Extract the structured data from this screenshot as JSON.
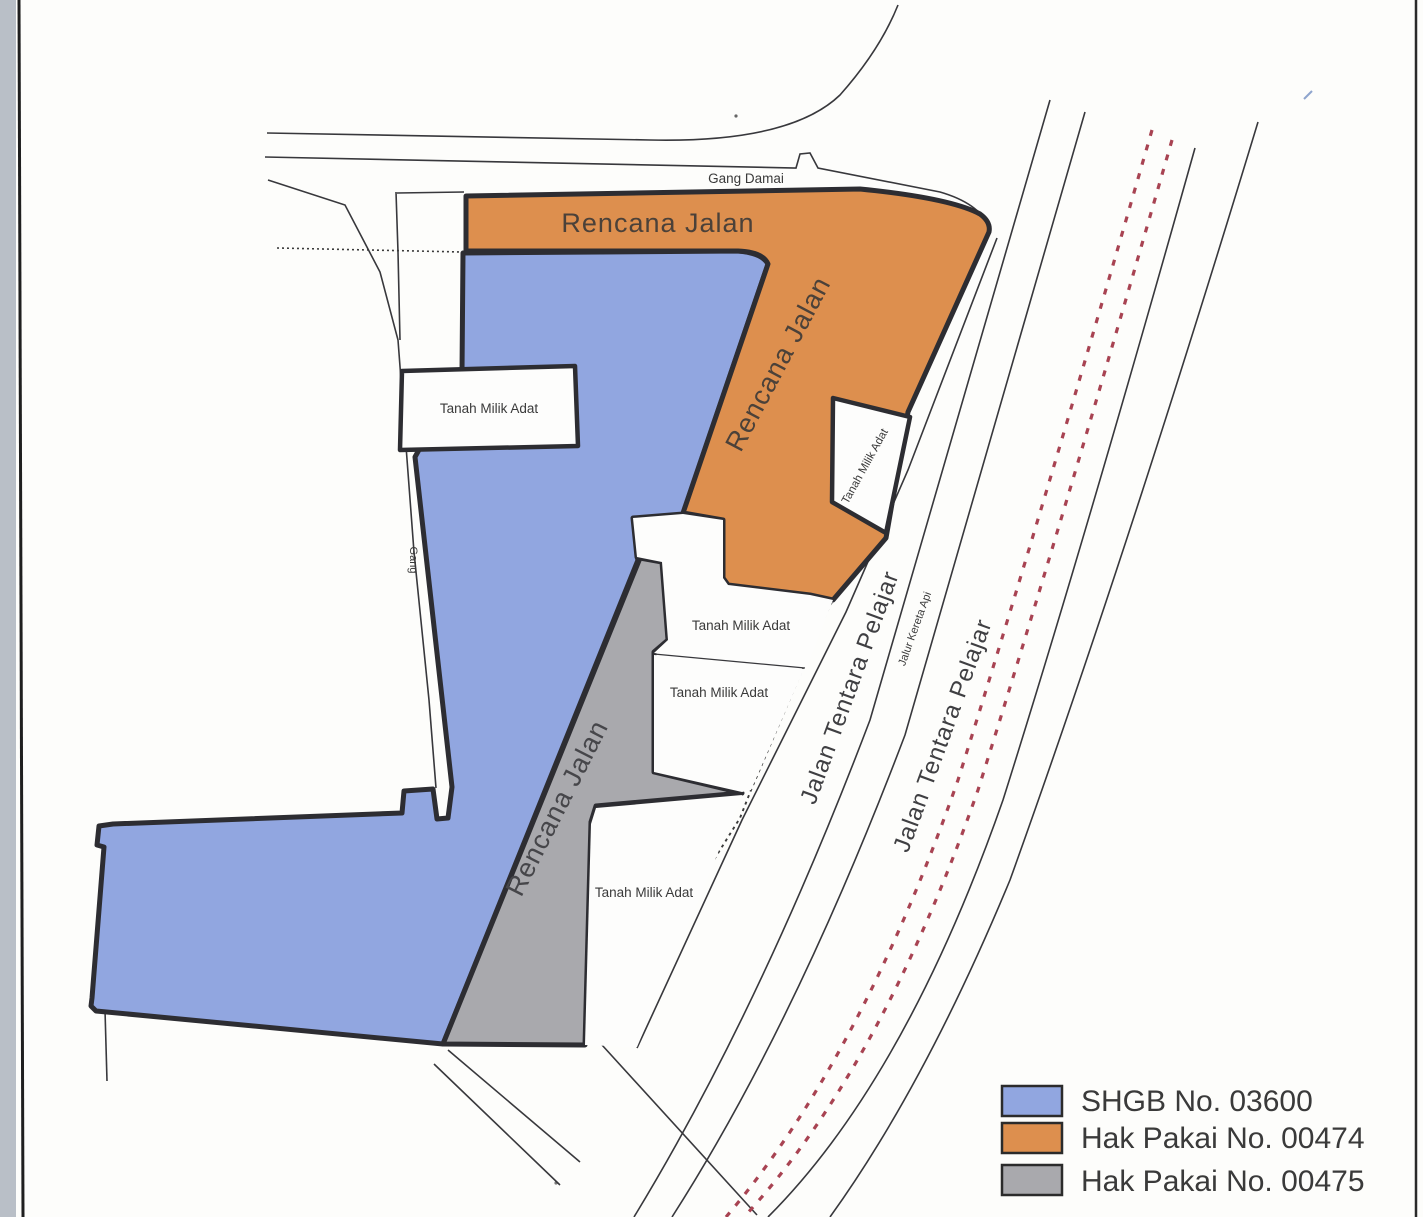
{
  "colors": {
    "region_blue": "#91a6e0",
    "region_orange": "#dd8f4e",
    "region_gray": "#a9a9ad",
    "region_border": "#2d2d32",
    "road_line": "#38383c",
    "rail_red": "#a84352",
    "label_brown": "#4b4139",
    "label_gray": "#46464a",
    "text_dark": "#3a3a3a",
    "scan_bar": "#b9bfc7",
    "scan_line": "#1f1f1f"
  },
  "legend": {
    "items": [
      {
        "label": "SHGB No. 03600",
        "color": "#91a6e0"
      },
      {
        "label": "Hak Pakai No. 00474",
        "color": "#dd8f4e"
      },
      {
        "label": "Hak Pakai No. 00475",
        "color": "#a9a9ad"
      }
    ]
  },
  "map_labels": {
    "gang_damai": "Gang Damai",
    "rencana_jalan_top": "Rencana Jalan",
    "rencana_jalan_orange": "Rencana Jalan",
    "rencana_jalan_gray": "Rencana Jalan",
    "gang": "Gang",
    "tanah_box": "Tanah Milik Adat",
    "tanah_small": "Tanah Milik Adat",
    "tanah_1": "Tanah Milik Adat",
    "tanah_2": "Tanah Milik Adat",
    "tanah_3": "Tanah Milik Adat",
    "jalan_tentara_1": "Jalan Tentara Pelajar",
    "jalan_tentara_2": "Jalan Tentara Pelajar",
    "jalur_kereta_api": "Jalur Kereta Api"
  }
}
